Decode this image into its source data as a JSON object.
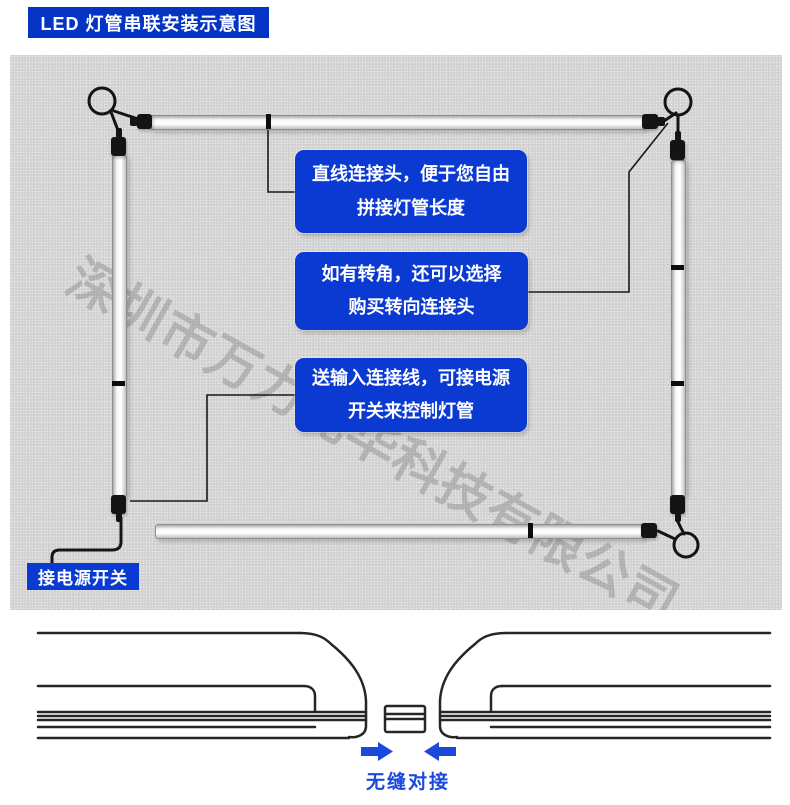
{
  "header": {
    "title": "LED 灯管串联安装示意图"
  },
  "colors": {
    "badge_blue": "#0534c4",
    "callout_blue": "#0a3ad1",
    "accent_blue": "#1a49dc",
    "panel_gray": "#d3d3d3",
    "watermark_gray": "rgba(120,120,120,0.38)"
  },
  "diagram": {
    "callouts": [
      {
        "line1": "直线连接头，便于您自由",
        "line2": "拼接灯管长度"
      },
      {
        "line1": "如有转角，还可以选择",
        "line2": "购买转向连接头"
      },
      {
        "line1": "送输入连接线，可接电源",
        "line2": "开关来控制灯管"
      }
    ],
    "power_switch_label": "接电源开关",
    "watermark": "深圳市万力光华科技有限公司"
  },
  "footer": {
    "caption": "无缝对接"
  }
}
